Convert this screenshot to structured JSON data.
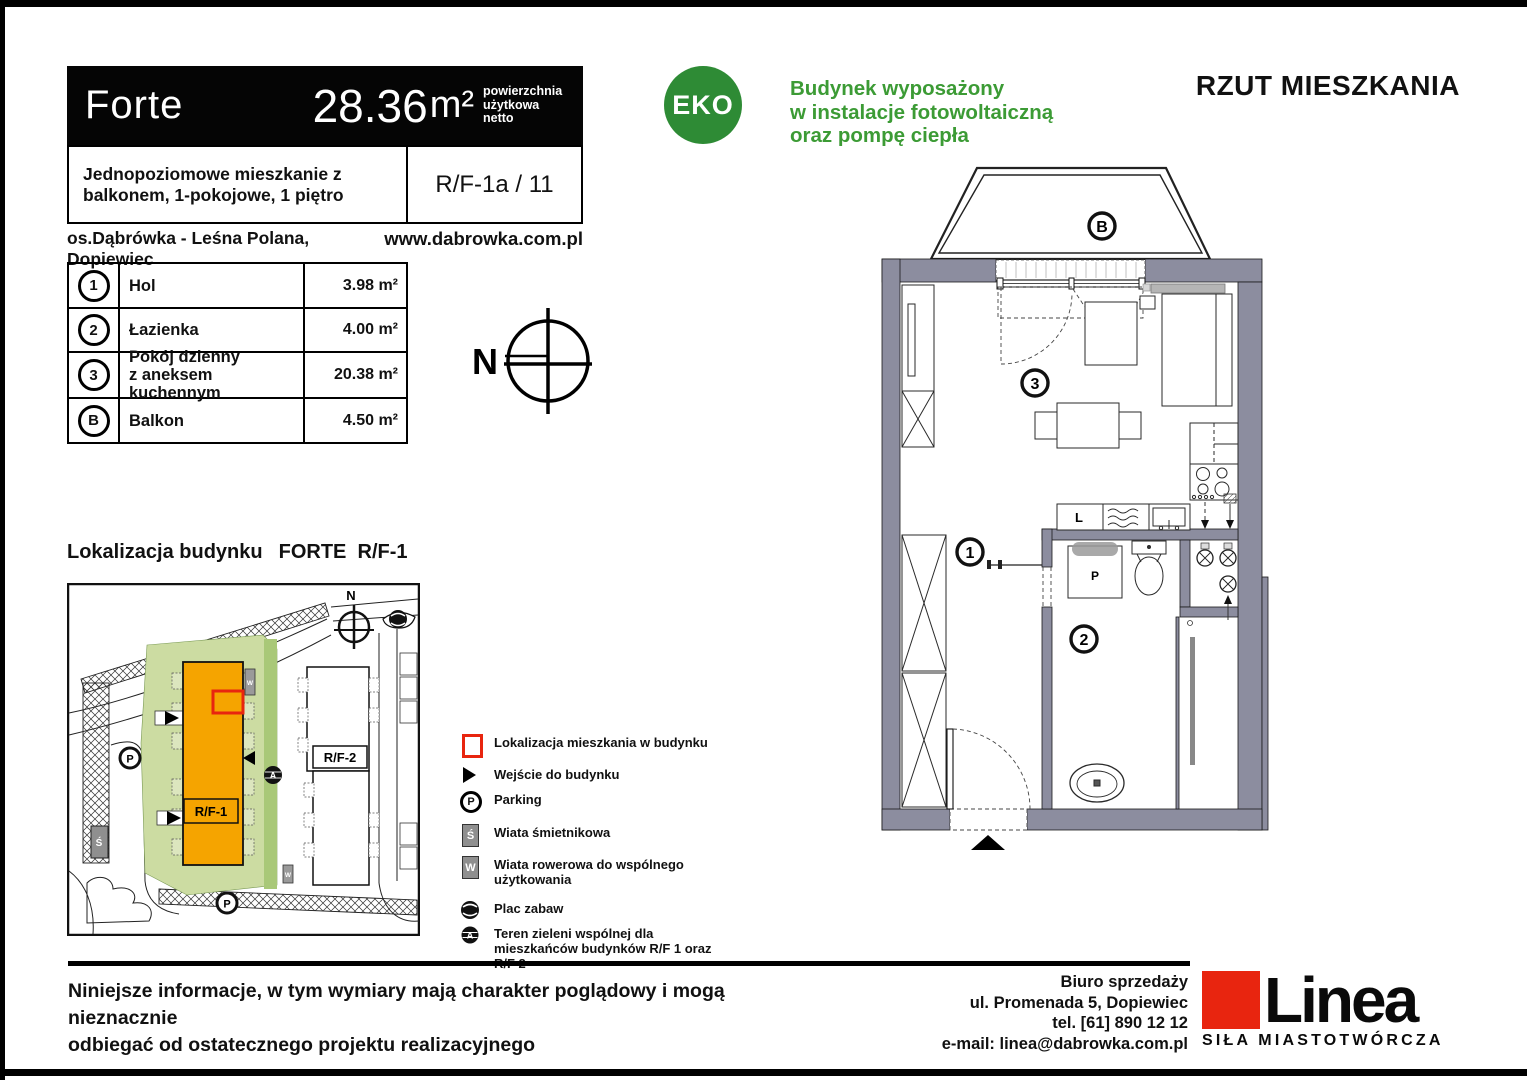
{
  "page": {
    "title": "RZUT MIESZKANIA",
    "compass_letter": "N"
  },
  "header": {
    "project_name": "Forte",
    "area_value": "28.36",
    "area_unit": "m²",
    "area_caption": "powierzchnia\nużytkowa\nnetto",
    "description": "Jednopoziomowe mieszkanie z balkonem, 1-pokojowe, 1 piętro",
    "unit_code": "R/F-1a / 11",
    "location": "os.Dąbrówka - Leśna Polana, Dopiewiec",
    "website": "www.dabrowka.com.pl"
  },
  "eco": {
    "badge": "EKO",
    "text": "Budynek wyposażony\nw instalacje fotowoltaiczną\noraz pompę ciepła"
  },
  "rooms": [
    {
      "id": "1",
      "name": "Hol",
      "area": "3.98 m²"
    },
    {
      "id": "2",
      "name": "Łazienka",
      "area": "4.00 m²"
    },
    {
      "id": "3",
      "name": "Pokój dzienny\nz aneksem kuchennym",
      "area": "20.38 m²"
    },
    {
      "id": "B",
      "name": "Balkon",
      "area": "4.50 m²"
    }
  ],
  "site_map": {
    "section_title_prefix": "Lokalizacja budynku",
    "section_title_building": "FORTE  R/F-1",
    "building1_label": "R/F-1",
    "building2_label": "R/F-2"
  },
  "symbols": {
    "parking": "P",
    "trash": "Ś",
    "bike": "W",
    "green_area": "A",
    "north": "N"
  },
  "legend": {
    "items": [
      {
        "label": "Lokalizacja mieszkania w budynku"
      },
      {
        "label": "Wejście do budynku"
      },
      {
        "label": "Parking"
      },
      {
        "label": "Wiata śmietnikowa"
      },
      {
        "label": "Wiata rowerowa do wspólnego użytkowania"
      },
      {
        "label": "Plac zabaw"
      },
      {
        "label": "Teren zieleni wspólnej dla mieszkańców budynków R/F 1 oraz R/F 2"
      }
    ]
  },
  "floor_plan": {
    "labels": {
      "balcony": "B",
      "hol": "1",
      "bathroom": "2",
      "living": "3",
      "fridge": "L",
      "washer": "P"
    }
  },
  "footer": {
    "disclaimer": "Niniejsze informacje, w tym wymiary mają charakter poglądowy i mogą nieznacznie\nodbiegać od ostatecznego projektu realizacyjnego",
    "office_line1": "Biuro sprzedaży",
    "office_line2": "ul. Promenada 5, Dopiewiec",
    "office_line3": "tel. [61] 890 12 12",
    "office_line4": "e-mail: linea@dabrowka.com.pl",
    "brand_name": "Linea",
    "brand_tagline": "SIŁA MIASTOTWÓRCZA"
  }
}
